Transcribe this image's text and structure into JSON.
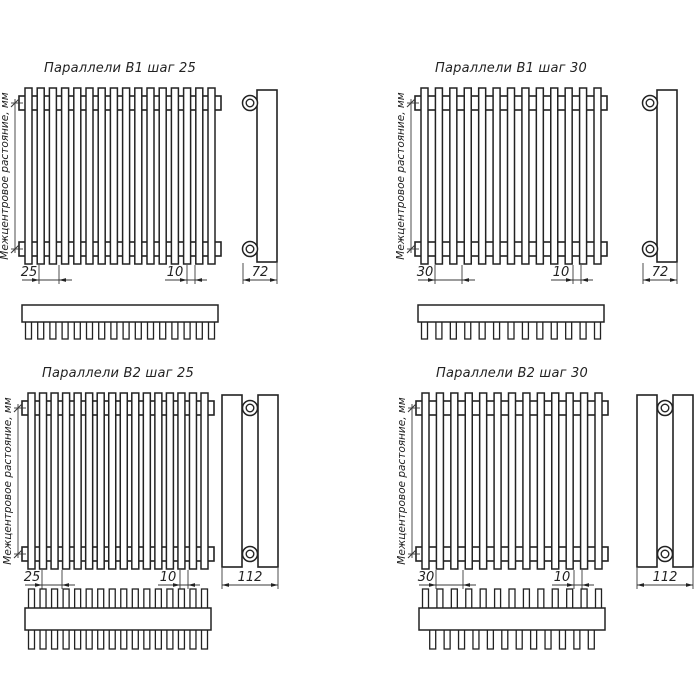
{
  "axis_label": "Межцентровое растояние, мм",
  "colors": {
    "line": "#222222",
    "thin": "#3a3a3a",
    "text": "#222222",
    "background": "#ffffff"
  },
  "panels": [
    {
      "title": "Параллели В1 шаг 25",
      "variant": "B1",
      "step": "25",
      "tube_width": "10",
      "depth": "72",
      "tubes": 16,
      "top_view": {
        "teeth_down": 16,
        "teeth_up": 0,
        "staggered_down": false
      }
    },
    {
      "title": "Параллели В1 шаг 30",
      "variant": "B1",
      "step": "30",
      "tube_width": "10",
      "depth": "72",
      "tubes": 13,
      "top_view": {
        "teeth_down": 13,
        "teeth_up": 0,
        "staggered_down": false
      }
    },
    {
      "title": "Параллели В2 шаг 25",
      "variant": "B2",
      "step": "25",
      "tube_width": "10",
      "depth": "112",
      "tubes": 16,
      "top_view": {
        "teeth_down": 16,
        "teeth_up": 16,
        "staggered_down": false
      }
    },
    {
      "title": "Параллели В2 шаг 30",
      "variant": "B2",
      "step": "30",
      "tube_width": "10",
      "depth": "112",
      "tubes": 13,
      "top_view": {
        "teeth_down": 12,
        "teeth_up": 13,
        "staggered_down": true
      }
    }
  ]
}
